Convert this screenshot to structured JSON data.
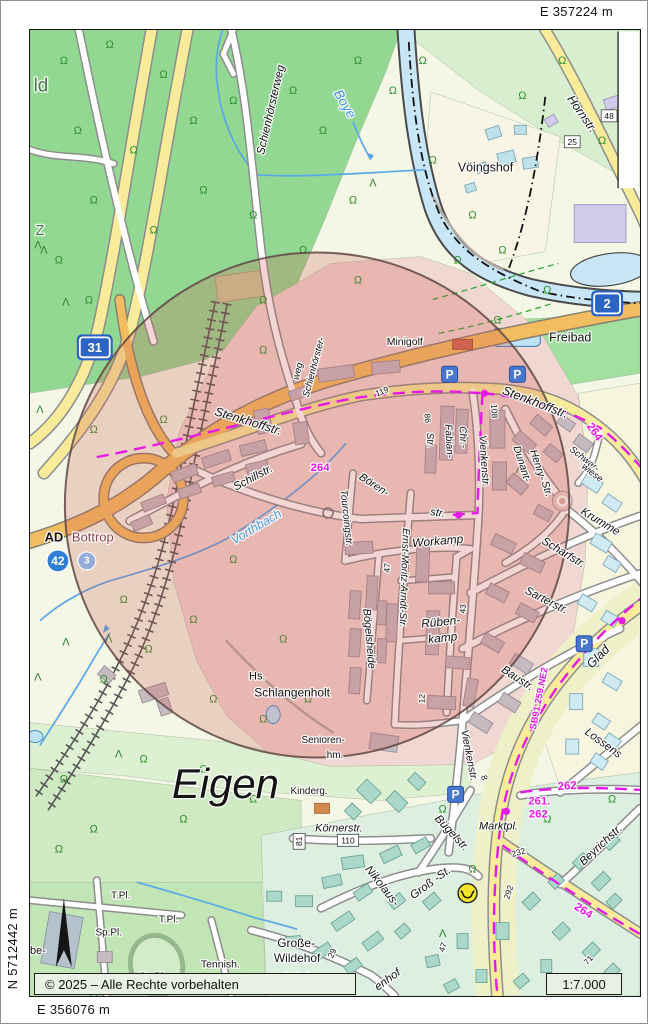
{
  "page": {
    "margin_labels": {
      "top_easting": "E 357224 m",
      "right_northing": "N 5714304 m",
      "left_northing": "N 5712442 m",
      "bottom_easting": "E 356076 m"
    },
    "footer": {
      "copyright": "© 2025 – Alle Rechte vorbehalten",
      "scale": "1:7.000"
    }
  },
  "map": {
    "overlay_circle": {
      "cx": 316,
      "cy": 504,
      "r": 253,
      "fill": "rgba(205,85,75,0.24)",
      "stroke": "rgba(95,72,66,0.85)"
    },
    "route_color": "#e61ae6",
    "parking": {
      "label": "P",
      "positions": [
        [
          449,
          373
        ],
        [
          517,
          373
        ],
        [
          584,
          643
        ],
        [
          455,
          794
        ]
      ]
    },
    "post_office": {
      "x": 467,
      "y": 893
    },
    "motorway_shields": [
      {
        "name": "shield-a31",
        "text": "31",
        "x": 93,
        "y": 346,
        "w": 30
      },
      {
        "name": "shield-a2",
        "text": "2",
        "x": 607,
        "y": 302,
        "w": 26
      }
    ],
    "junction_badges": [
      {
        "name": "badge-42",
        "text": "42",
        "x": 56,
        "y": 560,
        "r": 11,
        "fill": "#2f7fd4"
      },
      {
        "name": "badge-3",
        "text": "3",
        "x": 85,
        "y": 560,
        "r": 9,
        "fill": "#96abd6"
      }
    ],
    "route_dots": [
      [
        484,
        392
      ],
      [
        458,
        514
      ],
      [
        622,
        620
      ],
      [
        506,
        811
      ]
    ],
    "labels": [
      {
        "t": "ld",
        "x": 39,
        "y": 84,
        "s": 19,
        "c": "#4a7a4a"
      },
      {
        "t": "Z",
        "x": 38,
        "y": 229,
        "s": 15,
        "c": "#4a7a4a"
      },
      {
        "t": "Schienhörsterweg",
        "x": 270,
        "y": 108,
        "r": -77,
        "s": 11.5,
        "i": 1
      },
      {
        "t": "Schienhörster-",
        "x": 313,
        "y": 366,
        "r": -75,
        "s": 9.5,
        "i": 1
      },
      {
        "t": "weg",
        "x": 297,
        "y": 370,
        "r": -77,
        "s": 9.5,
        "i": 1
      },
      {
        "t": "Boye",
        "x": 344,
        "y": 102,
        "r": 60,
        "s": 13.5,
        "c": "#3f93dc",
        "i": 1
      },
      {
        "t": "Hornstr.",
        "x": 582,
        "y": 112,
        "r": 55,
        "s": 12,
        "i": 1
      },
      {
        "t": "48",
        "x": 609,
        "y": 114,
        "s": 8.5,
        "box": 1
      },
      {
        "t": "25",
        "x": 572,
        "y": 140,
        "s": 8.5,
        "box": 1
      },
      {
        "t": "Vöingshof",
        "x": 485,
        "y": 166,
        "s": 12.5
      },
      {
        "t": "Freibad",
        "x": 570,
        "y": 336,
        "s": 12.5
      },
      {
        "t": "Minigolf",
        "x": 404,
        "y": 341,
        "s": 10.5
      },
      {
        "t": "Stenkhoffstr.",
        "x": 247,
        "y": 420,
        "r": 17,
        "s": 12.5,
        "i": 1
      },
      {
        "t": "Stenkhoffstr.",
        "x": 535,
        "y": 401,
        "r": 21,
        "s": 12.5,
        "i": 1
      },
      {
        "t": "264",
        "x": 594,
        "y": 431,
        "r": 55,
        "s": 11.5,
        "c": "#e61ae6",
        "b": 1
      },
      {
        "t": "264",
        "x": 319,
        "y": 467,
        "s": 11.5,
        "c": "#e61ae6",
        "b": 1
      },
      {
        "t": "119",
        "x": 381,
        "y": 390,
        "r": -22,
        "s": 8.5
      },
      {
        "t": "108",
        "x": 494,
        "y": 410,
        "r": 87,
        "s": 8.5
      },
      {
        "t": "86",
        "x": 427,
        "y": 417,
        "r": 87,
        "s": 8.5
      },
      {
        "t": "Str.",
        "x": 429,
        "y": 439,
        "r": 87,
        "s": 10,
        "i": 1
      },
      {
        "t": "Fabian-",
        "x": 448,
        "y": 440,
        "r": 87,
        "s": 10,
        "i": 1
      },
      {
        "t": "Chr.-",
        "x": 462,
        "y": 436,
        "r": 87,
        "s": 10,
        "i": 1
      },
      {
        "t": "Vienkenstr.",
        "x": 483,
        "y": 460,
        "r": 86,
        "s": 10.5,
        "i": 1
      },
      {
        "t": "Schillstr.",
        "x": 252,
        "y": 477,
        "r": -28,
        "s": 11.5,
        "i": 1
      },
      {
        "t": "Vorthbach",
        "x": 255,
        "y": 526,
        "r": -31,
        "s": 12.5,
        "c": "#4a94d8",
        "i": 1
      },
      {
        "t": "AD",
        "x": 52,
        "y": 536,
        "s": 13,
        "b": 1
      },
      {
        "t": "Bottrop",
        "x": 91,
        "y": 536,
        "s": 13,
        "c": "#8a4650"
      },
      {
        "t": "Bören-",
        "x": 373,
        "y": 484,
        "r": 33,
        "s": 11,
        "i": 1
      },
      {
        "t": "str.",
        "x": 437,
        "y": 512,
        "r": 8,
        "s": 11,
        "i": 1
      },
      {
        "t": "Tourcoingstr.",
        "x": 345,
        "y": 517,
        "r": 84,
        "s": 10,
        "i": 1
      },
      {
        "t": "Ernst-Moritz-Arndt-Str.",
        "x": 403,
        "y": 577,
        "r": 92,
        "s": 10,
        "i": 1
      },
      {
        "t": "Workamp",
        "x": 437,
        "y": 540,
        "r": -5,
        "s": 12,
        "i": 1
      },
      {
        "t": "47",
        "x": 386,
        "y": 567,
        "r": -87,
        "s": 8.5
      },
      {
        "t": "Bögelsheide",
        "x": 368,
        "y": 638,
        "r": 85,
        "s": 11,
        "i": 1
      },
      {
        "t": "Rüben-",
        "x": 440,
        "y": 621,
        "r": -6,
        "s": 12,
        "i": 1
      },
      {
        "t": "kamp",
        "x": 442,
        "y": 637,
        "r": -6,
        "s": 12,
        "i": 1
      },
      {
        "t": "43",
        "x": 462,
        "y": 608,
        "r": -87,
        "s": 8.5
      },
      {
        "t": "12",
        "x": 421,
        "y": 698,
        "r": -87,
        "s": 8.5
      },
      {
        "t": "Henry-",
        "x": 537,
        "y": 464,
        "r": 72,
        "s": 10.5,
        "i": 1
      },
      {
        "t": "Dunant-",
        "x": 521,
        "y": 463,
        "r": 72,
        "s": 10.5,
        "i": 1
      },
      {
        "t": "Str.",
        "x": 546,
        "y": 488,
        "r": 72,
        "s": 10.5,
        "i": 1
      },
      {
        "t": "Schwar-",
        "x": 584,
        "y": 458,
        "r": 38,
        "s": 9.5,
        "i": 1
      },
      {
        "t": "wiese",
        "x": 592,
        "y": 472,
        "r": 38,
        "s": 9.5,
        "i": 1
      },
      {
        "t": "Krumme",
        "x": 600,
        "y": 521,
        "r": 31,
        "s": 11.5,
        "i": 1
      },
      {
        "t": "Scharfstr.",
        "x": 563,
        "y": 552,
        "r": 31,
        "s": 11.5,
        "i": 1
      },
      {
        "t": "Sarterstr.",
        "x": 546,
        "y": 600,
        "r": 27,
        "s": 11.5,
        "i": 1
      },
      {
        "t": "Baustr.",
        "x": 517,
        "y": 678,
        "r": 33,
        "s": 11.5,
        "i": 1
      },
      {
        "t": "Glad",
        "x": 598,
        "y": 656,
        "r": -45,
        "s": 12.5,
        "i": 1
      },
      {
        "t": "SB91.259.NE2",
        "x": 539,
        "y": 698,
        "r": -79,
        "s": 9.5,
        "c": "#e61ae6",
        "b": 1
      },
      {
        "t": "Lossens",
        "x": 603,
        "y": 743,
        "r": 36,
        "s": 11.5,
        "i": 1
      },
      {
        "t": "Vienkenstr.",
        "x": 468,
        "y": 755,
        "r": 79,
        "s": 10.5,
        "i": 1
      },
      {
        "t": "8",
        "x": 484,
        "y": 777,
        "r": 79,
        "s": 8.5
      },
      {
        "t": "Hs.",
        "x": 256,
        "y": 676,
        "s": 11
      },
      {
        "t": "Schlangenholt",
        "x": 291,
        "y": 692,
        "s": 12
      },
      {
        "t": "Senioren-",
        "x": 322,
        "y": 740,
        "s": 10
      },
      {
        "t": "hm.",
        "x": 334,
        "y": 755,
        "s": 10
      },
      {
        "t": "Eigen",
        "x": 224,
        "y": 783,
        "s": 42,
        "i": 1
      },
      {
        "t": "Kinderg.",
        "x": 308,
        "y": 791,
        "s": 10
      },
      {
        "t": "Körnerstr.",
        "x": 338,
        "y": 828,
        "s": 11,
        "i": 1
      },
      {
        "t": "81",
        "x": 298,
        "y": 841,
        "r": -90,
        "s": 8.5,
        "box": 1
      },
      {
        "t": "110",
        "x": 347,
        "y": 840,
        "s": 8.5,
        "box": 1
      },
      {
        "t": "Bügelstr.",
        "x": 451,
        "y": 833,
        "r": 47,
        "s": 11.5,
        "i": 1
      },
      {
        "t": "Marktpl.",
        "x": 498,
        "y": 826,
        "s": 11,
        "i": 1
      },
      {
        "t": "232",
        "x": 518,
        "y": 852,
        "r": -15,
        "s": 8.5
      },
      {
        "t": "292",
        "x": 508,
        "y": 892,
        "r": -72,
        "s": 8.5
      },
      {
        "t": "261.",
        "x": 539,
        "y": 801,
        "s": 11.5,
        "c": "#e61ae6",
        "b": 1
      },
      {
        "t": "262",
        "x": 538,
        "y": 814,
        "s": 11.5,
        "c": "#e61ae6",
        "b": 1
      },
      {
        "t": "262",
        "x": 567,
        "y": 786,
        "r": -4,
        "s": 11.5,
        "c": "#e61ae6",
        "b": 1
      },
      {
        "t": "264",
        "x": 583,
        "y": 911,
        "r": 33,
        "s": 11.5,
        "c": "#e61ae6",
        "b": 1
      },
      {
        "t": "Beyrichstr.",
        "x": 601,
        "y": 845,
        "r": -43,
        "s": 11.5,
        "i": 1
      },
      {
        "t": "Nikolaus-",
        "x": 381,
        "y": 886,
        "r": 52,
        "s": 11.5,
        "i": 1
      },
      {
        "t": "Groß -St.",
        "x": 430,
        "y": 883,
        "r": -36,
        "s": 11.5,
        "i": 1
      },
      {
        "t": "47",
        "x": 442,
        "y": 947,
        "r": -72,
        "s": 8.5
      },
      {
        "t": "29",
        "x": 331,
        "y": 953,
        "r": -65,
        "s": 8.5
      },
      {
        "t": "Große-",
        "x": 295,
        "y": 943,
        "s": 12
      },
      {
        "t": "Wildehof",
        "x": 296,
        "y": 958,
        "s": 12
      },
      {
        "t": "Reitpl.",
        "x": 297,
        "y": 978,
        "s": 10
      },
      {
        "t": "enhof",
        "x": 387,
        "y": 980,
        "r": -36,
        "s": 11.5,
        "i": 1
      },
      {
        "t": "71",
        "x": 588,
        "y": 960,
        "r": -50,
        "s": 8.5
      },
      {
        "t": "T.Pl.",
        "x": 119,
        "y": 896,
        "s": 10
      },
      {
        "t": "T.Pl.",
        "x": 167,
        "y": 920,
        "s": 10
      },
      {
        "t": "Sp.Pl.",
        "x": 107,
        "y": 933,
        "s": 10
      },
      {
        "t": "Sp.Pl.",
        "x": 151,
        "y": 977,
        "s": 10
      },
      {
        "t": "Tennish.",
        "x": 219,
        "y": 965,
        "s": 10.5
      },
      {
        "t": "be-",
        "x": 36,
        "y": 951,
        "s": 11
      }
    ]
  }
}
